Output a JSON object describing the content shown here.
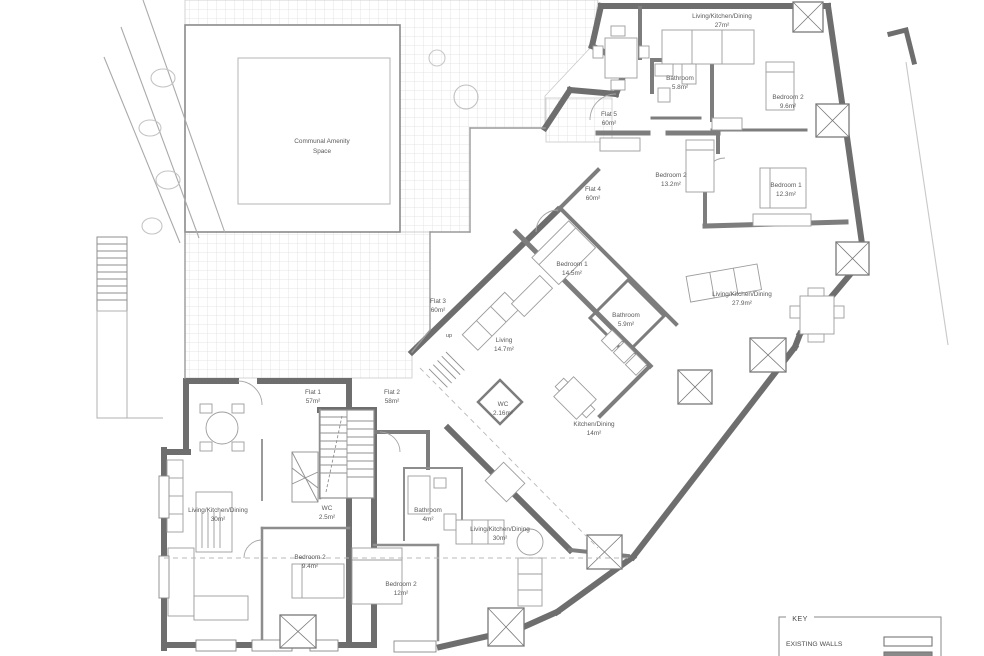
{
  "plan": {
    "labels": {
      "communal": {
        "l1": "Communal Amenity",
        "l2": "Space"
      },
      "lkd27": {
        "l1": "Living/Kitchen/Dining",
        "l2": "27m²"
      },
      "bath58": {
        "l1": "Bathroom",
        "l2": "5.8m²"
      },
      "bed2_96": {
        "l1": "Bedroom 2",
        "l2": "9.6m²"
      },
      "flat5": {
        "l1": "Flat 5",
        "l2": "60m²"
      },
      "bed2_132": {
        "l1": "Bedroom 2",
        "l2": "13.2m²"
      },
      "flat4": {
        "l1": "Flat 4",
        "l2": "60m²"
      },
      "bed1_123": {
        "l1": "Bedroom 1",
        "l2": "12.3m²"
      },
      "bed1_145": {
        "l1": "Bedroom 1",
        "l2": "14.5m²"
      },
      "bath59": {
        "l1": "Bathroom",
        "l2": "5.9m²"
      },
      "living147": {
        "l1": "Living",
        "l2": "14.7m²"
      },
      "flat3": {
        "l1": "Flat 3",
        "l2": "60m²"
      },
      "lkd279": {
        "l1": "Living/Kitchen/Dining",
        "l2": "27.9m²"
      },
      "flat1": {
        "l1": "Flat 1",
        "l2": "57m²"
      },
      "flat2": {
        "l1": "Flat 2",
        "l2": "58m²"
      },
      "wc25": {
        "l1": "WC",
        "l2": "2.5m²"
      },
      "lkd30a": {
        "l1": "Living/Kitchen/Dining",
        "l2": "30m²"
      },
      "bed2_94": {
        "l1": "Bedroom 2",
        "l2": "9.4m²"
      },
      "bed2_12": {
        "l1": "Bedroom 2",
        "l2": "12m²"
      },
      "bath4": {
        "l1": "Bathroom",
        "l2": "4m²"
      },
      "lkd30b": {
        "l1": "Living/Kitchen/Dining",
        "l2": "30m²"
      },
      "kd14": {
        "l1": "Kitchen/Dining",
        "l2": "14m²"
      },
      "wc216": {
        "l1": "WC",
        "l2": "2.16m²"
      },
      "up": {
        "l1": "up"
      }
    },
    "colors": {
      "wall": "#6e6e6e",
      "thin_line": "#9a9a9a",
      "grid": "#dedede",
      "text": "#5a5a5a"
    }
  },
  "key": {
    "title": "KEY",
    "rows": [
      {
        "label": "EXISTING WALLS",
        "swatch": "outline"
      },
      {
        "label": "",
        "swatch": "filled"
      }
    ]
  }
}
